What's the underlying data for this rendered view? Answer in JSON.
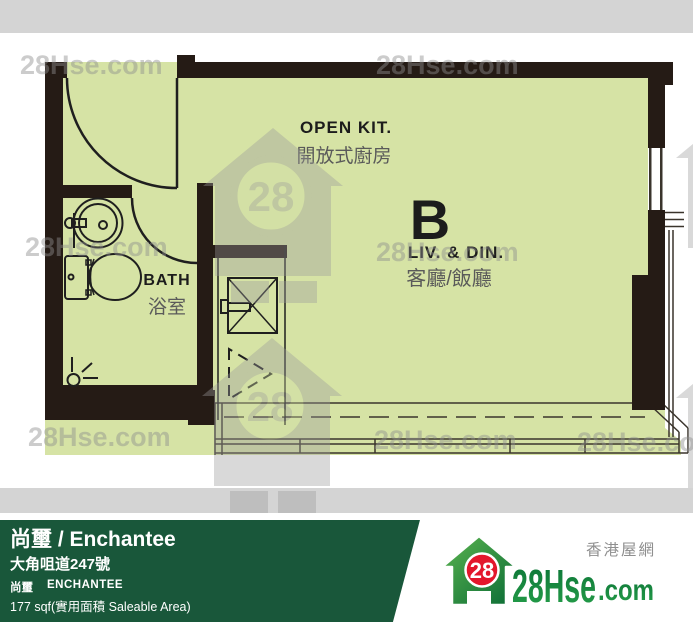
{
  "plan": {
    "unit_label": "B",
    "labels": {
      "kitchen_en": "OPEN KIT.",
      "kitchen_zh": "開放式廚房",
      "living_en": "LIV. & DIN.",
      "living_zh": "客廳/飯廳",
      "bath_en": "BATH",
      "bath_zh": "浴室"
    }
  },
  "watermark": {
    "text": "28Hse.com",
    "number": "28"
  },
  "footer": {
    "title": "尚璽 / Enchantee",
    "address": "大角咀道247號",
    "name_zh": "尚璽",
    "name_en": "ENCHANTEE",
    "area": "177 sqf(實用面積 Saleable Area)",
    "logo": {
      "number": "28",
      "brand": "28Hse",
      "suffix": ".com",
      "tagline": "香港屋網"
    }
  },
  "colors": {
    "floor_green": "#d6e3a5",
    "wall_dark": "#251b15",
    "gray_bar": "#d4d4d4",
    "watermark_gray": "#8f8f8f",
    "footer_green": "#19573a",
    "logo_green_dark": "#0a7236",
    "logo_green_light": "#27a04a",
    "logo_red": "#e3172c",
    "label_gray": "#5a5a5a"
  }
}
